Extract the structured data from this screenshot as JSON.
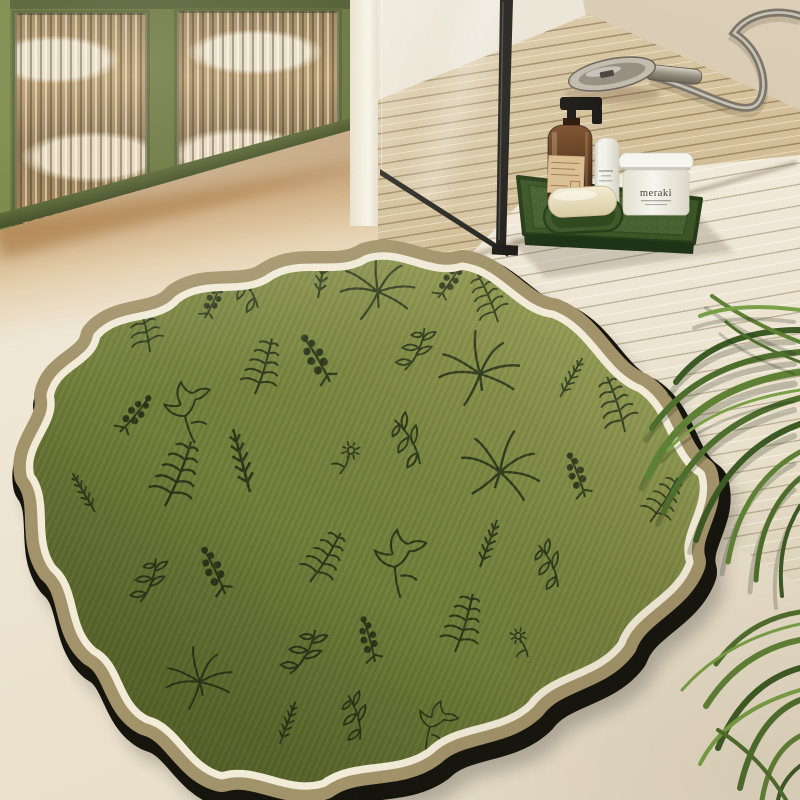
{
  "scene": {
    "type": "product-photo",
    "description": "Olive-green bath mat with wavy scalloped cream-and-tan border and black botanical line-art print, lying on a cream stone bathroom floor. Behind it: a green cabinet with fluted glass doors holding towels, a walk-in shower with black-framed glass and a wooden slatted floor, a handheld shower head with hose, a white slatted duckboard, and a green tray of toiletries. Palm fronds enter from the right edge.",
    "objects": [
      "green fluted-glass cabinet with towels",
      "white wall pillar",
      "black framed shower glass",
      "wooden slatted shower floor",
      "handheld shower head with hose",
      "white slatted duckboard",
      "green toiletry tray",
      "amber pump soap bottle with kraft label",
      "white cosmetic tube",
      "meraki cream jar",
      "bar of soap on green soap dish",
      "wavy botanical bath mat",
      "palm fronds",
      "cream stone floor"
    ]
  },
  "products": {
    "jar_label": "meraki"
  },
  "palette": {
    "floor_cream": "#ece3d1",
    "floor_warm": "#c89a5f",
    "cabinet_green": "#5a682c",
    "cabinet_frame_dark": "#47551f",
    "pillar_white": "#f6f2e6",
    "wood_slat": "#d5c29c",
    "white_slat": "#eee6d4",
    "glass_frame_black": "#21201c",
    "tray_green": "#3c5526",
    "soap_cream": "#eee6c9",
    "bottle_amber": "#6a4526",
    "label_kraft": "#dcbf93",
    "jar_white": "#f2f1e7",
    "plant_green": "#567a33",
    "rug_green": "#75813d",
    "rug_ink": "#242e15",
    "border_white": "#f1ebd8",
    "border_tan": "#a2936a",
    "rug_backing": "#15150e"
  }
}
